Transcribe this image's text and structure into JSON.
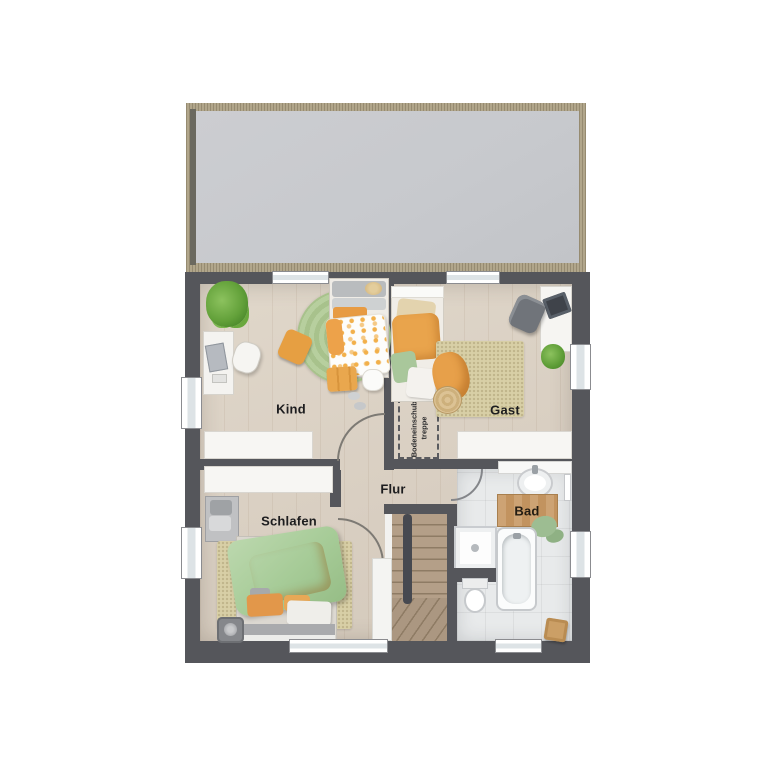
{
  "plan": {
    "type": "floor-plan",
    "floor": "upper-floor"
  },
  "rooms": {
    "kind": {
      "label": "Kind"
    },
    "gast": {
      "label": "Gast"
    },
    "flur": {
      "label": "Flur"
    },
    "schlafen": {
      "label": "Schlafen"
    },
    "bad": {
      "label": "Bad"
    }
  },
  "attic_hatch": {
    "label_line1": "Bodeneinschub-",
    "label_line2": "treppe"
  },
  "colors": {
    "wall": "#55565b",
    "terrace_fill": "#c7c9cd",
    "terrace_trim": "#b1a68b",
    "wood_floor": "#dcd3c6",
    "tile_floor": "#e8eaeb",
    "rug_beige": "#d8cfa8",
    "rug_green": "#aec896",
    "accent_orange": "#e8a34f",
    "accent_green": "#a9c79b",
    "stair_wood": "#b3a089",
    "window": "#ffffff"
  }
}
